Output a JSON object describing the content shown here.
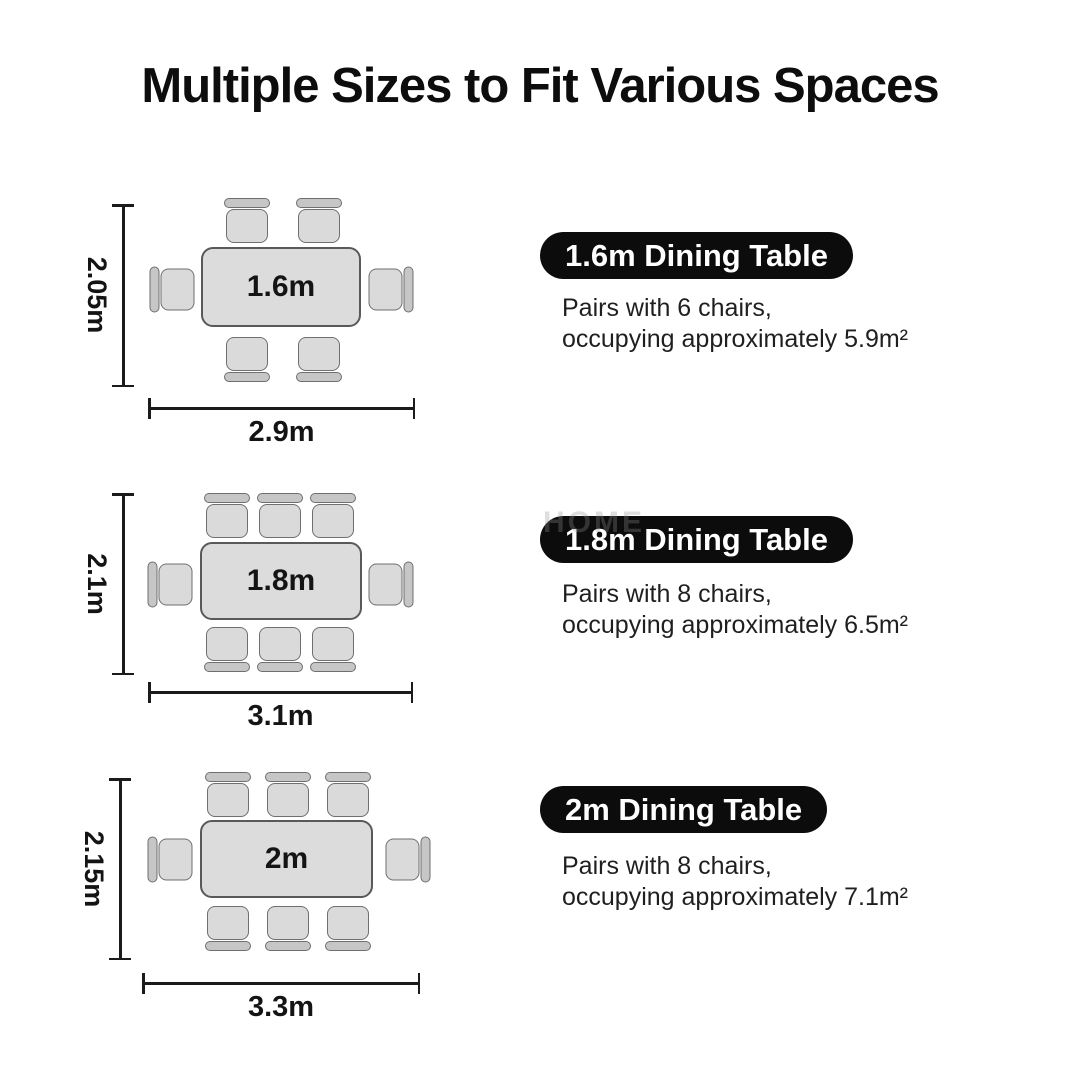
{
  "title": "Multiple Sizes to Fit Various Spaces",
  "watermark": "HOME",
  "colors": {
    "background": "#ffffff",
    "table_fill": "#dcdcdc",
    "chair_seat_fill": "#dadada",
    "chair_back_fill": "#c6c6c6",
    "outline": "#6f6f6f",
    "dimension_line": "#1b1b1b",
    "pill_bg": "#0c0c0c",
    "pill_text": "#ffffff",
    "body_text": "#1f1f1f"
  },
  "sections": [
    {
      "pill_label": "1.6m Dining Table",
      "desc_line1": "Pairs with 6 chairs,",
      "desc_line2": "occupying approximately 5.9m²",
      "table_label": "1.6m",
      "chair_count": 6,
      "space_width": "2.9m",
      "space_depth": "2.05m",
      "occupied_area": "5.9m²"
    },
    {
      "pill_label": "1.8m Dining Table",
      "desc_line1": "Pairs with 8 chairs,",
      "desc_line2": "occupying approximately 6.5m²",
      "table_label": "1.8m",
      "chair_count": 8,
      "space_width": "3.1m",
      "space_depth": "2.1m",
      "occupied_area": "6.5m²"
    },
    {
      "pill_label": "2m Dining Table",
      "desc_line1": "Pairs with 8 chairs,",
      "desc_line2": "occupying approximately 7.1m²",
      "table_label": "2m",
      "chair_count": 8,
      "space_width": "3.3m",
      "space_depth": "2.15m",
      "occupied_area": "7.1m²"
    }
  ]
}
